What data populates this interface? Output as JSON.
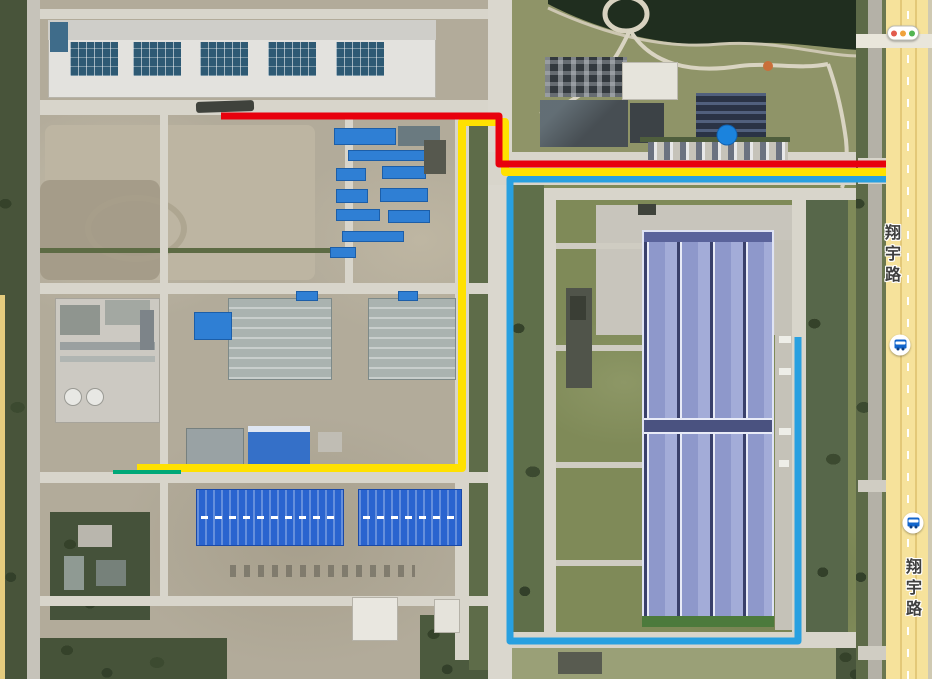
{
  "map_overlay": {
    "road_labels": [
      {
        "text": "翔宇路",
        "x": 893,
        "y": 224
      },
      {
        "text": "翔宇路",
        "x": 914,
        "y": 558
      }
    ],
    "routes": [
      {
        "name": "blue-route",
        "color": "#28a0e0",
        "width": 7,
        "points": [
          [
            886,
            179
          ],
          [
            510,
            179
          ],
          [
            510,
            641
          ],
          [
            798,
            641
          ],
          [
            798,
            337
          ]
        ]
      },
      {
        "name": "yellow-route",
        "color": "#ffe100",
        "width": 8,
        "points": [
          [
            137,
            468
          ],
          [
            462,
            468
          ],
          [
            462,
            122
          ],
          [
            505,
            122
          ],
          [
            505,
            172
          ],
          [
            886,
            172
          ]
        ]
      },
      {
        "name": "green-segment",
        "color": "#00a878",
        "width": 4,
        "points": [
          [
            113,
            472
          ],
          [
            181,
            472
          ]
        ]
      },
      {
        "name": "red-route",
        "color": "#e8000d",
        "width": 7,
        "points": [
          [
            221,
            116
          ],
          [
            499,
            116
          ],
          [
            499,
            164
          ],
          [
            886,
            164
          ]
        ]
      }
    ],
    "markers": {
      "location_dot": {
        "x": 727,
        "y": 135
      },
      "traffic_light": {
        "x": 903,
        "y": 33,
        "lights": [
          "#e25b4d",
          "#f0a23c",
          "#53b552"
        ]
      },
      "bus_stops": [
        {
          "x": 900,
          "y": 345
        },
        {
          "x": 913,
          "y": 523
        }
      ]
    }
  }
}
